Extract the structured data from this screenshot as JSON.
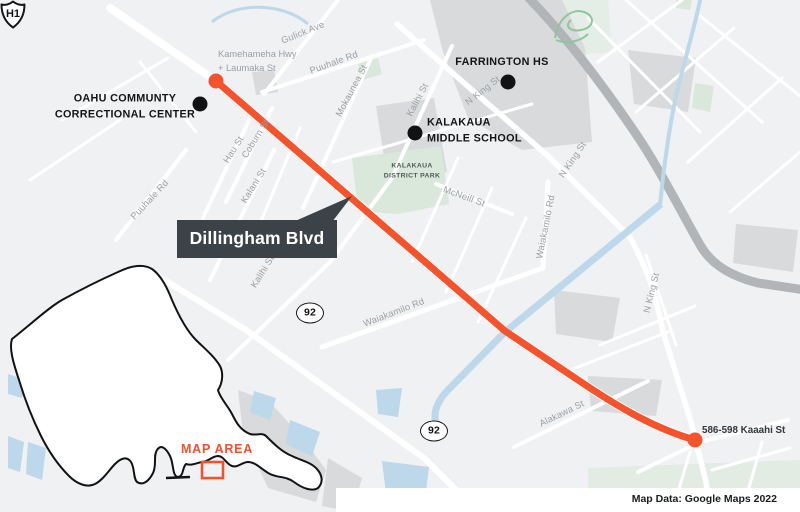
{
  "route": {
    "callout_label": "Dillingham Blvd",
    "endpoint_label": "586-598 Kaaahi St"
  },
  "pois": {
    "occc_line1": "OAHU COMMUNTY",
    "occc_line2": "CORRECTIONAL CENTER",
    "farrington": "FARRINGTON HS",
    "kms_line1": "KALAKAUA",
    "kms_line2": "MIDDLE SCHOOL",
    "park_line1": "KALAKAUA",
    "park_line2": "DISTRICT PARK"
  },
  "streets": {
    "kam_line1": "Kamehameha Hwy",
    "kam_line2": "+ Laumaka St",
    "gulick": "Gulick Ave",
    "puuhale_top": "Puuhale Rd",
    "mokaunea": "Mokaunea St",
    "kalihi_upper": "Kalihi St",
    "nking_upper": "N King St",
    "nking_right": "N King St",
    "coburn": "Coburn St",
    "hau": "Hau St",
    "kalani": "Kalani St",
    "puuhale_left": "Puuhale Rd",
    "waiakamilo_vertical": "Waiakamilo Rd",
    "mcneill": "McNeill St",
    "waiakamilo_mid": "Waiakamilo Rd",
    "kalihi_lower": "Kalihi St",
    "alakawa": "Alakawa St",
    "nking_lower": "N King St"
  },
  "shields": {
    "h1": "H1",
    "route_92": "92"
  },
  "inset": {
    "map_area_label": "MAP AREA"
  },
  "attribution": "Map Data: Google Maps 2022",
  "colors": {
    "route_orange": "#F6532D",
    "accent_orange": "#F4502A",
    "callout_bg": "#3B4248",
    "water_blue": "#BCD8EA",
    "park_green": "#D9E8DA",
    "block_gray": "#D8DADC",
    "freeway_gray": "#B2B5B7",
    "background": "#EFF1F2",
    "street_label_gray": "#9AA0A4"
  }
}
